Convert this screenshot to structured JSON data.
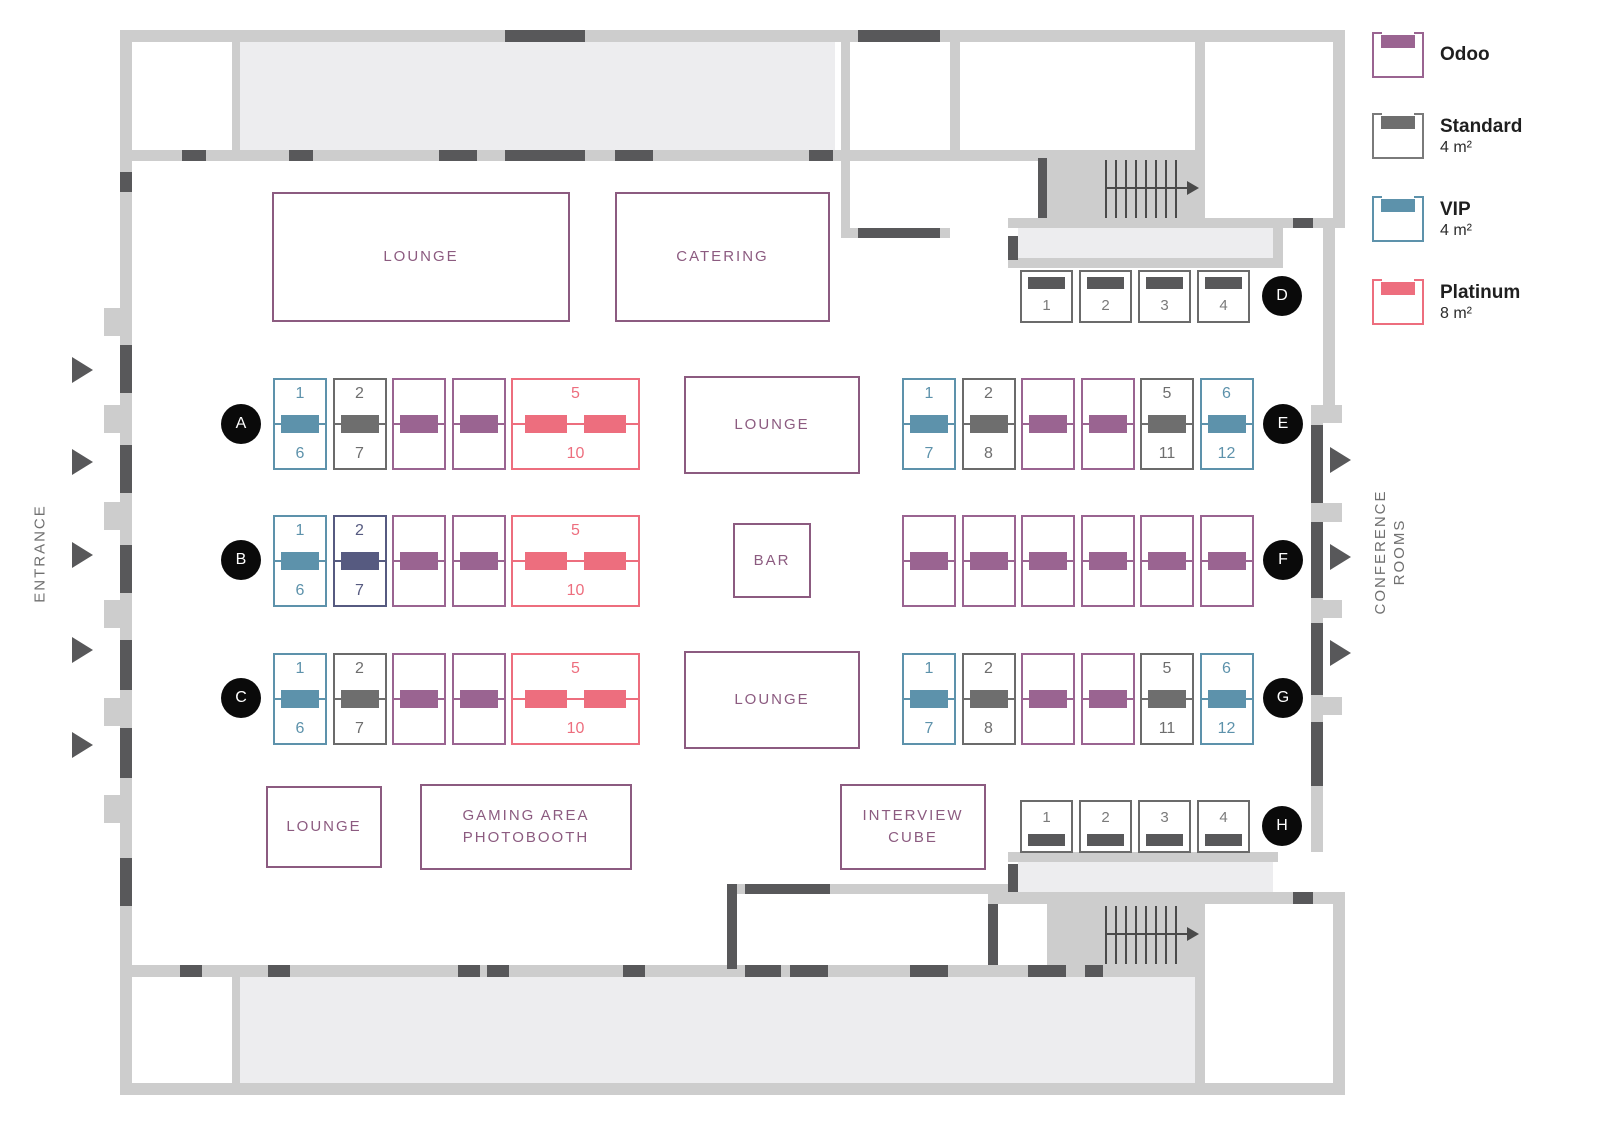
{
  "plan": {
    "entrance_label": "ENTRANCE",
    "conference_label_lines": [
      "CONFERENCE",
      "ROOMS"
    ]
  },
  "colors": {
    "odoo": "#9a6491",
    "standard": "#6e6e6e",
    "standard_border": "#6b6b6b",
    "vip": "#5d92ab",
    "platinum": "#ed6e7e",
    "indigo": "#565a80",
    "wall": "#cdcdcd",
    "room_fill": "#ededef",
    "door": "#58585a",
    "marker_bg": "#0a0a0a",
    "area_text": "#8c5b80",
    "side_label": "#707070"
  },
  "legend": {
    "items": [
      {
        "id": "odoo",
        "label": "Odoo",
        "size": ""
      },
      {
        "id": "standard",
        "label": "Standard",
        "size": "4 m²"
      },
      {
        "id": "vip",
        "label": "VIP",
        "size": "4 m²"
      },
      {
        "id": "platinum",
        "label": "Platinum",
        "size": "8 m²"
      }
    ]
  },
  "areas": [
    {
      "key": "lounge-top",
      "lines": [
        "LOUNGE"
      ]
    },
    {
      "key": "catering",
      "lines": [
        "CATERING"
      ]
    },
    {
      "key": "lounge-middle",
      "lines": [
        "LOUNGE"
      ]
    },
    {
      "key": "bar",
      "lines": [
        "BAR"
      ]
    },
    {
      "key": "lounge-lower",
      "lines": [
        "LOUNGE"
      ]
    },
    {
      "key": "lounge-small",
      "lines": [
        "LOUNGE"
      ]
    },
    {
      "key": "gaming",
      "lines": [
        "GAMING AREA",
        "PHOTOBOOTH"
      ]
    },
    {
      "key": "interview",
      "lines": [
        "INTERVIEW",
        "CUBE"
      ]
    }
  ],
  "rows": [
    {
      "id": "A",
      "booths": [
        {
          "type": "vip",
          "top": "1",
          "bottom": "6"
        },
        {
          "type": "standard",
          "top": "2",
          "bottom": "7"
        },
        {
          "type": "odoo"
        },
        {
          "type": "odoo"
        },
        {
          "type": "platinum",
          "top": "5",
          "bottom": "10"
        }
      ]
    },
    {
      "id": "B",
      "booths": [
        {
          "type": "vip",
          "top": "1",
          "bottom": "6"
        },
        {
          "type": "indigo",
          "top": "2",
          "bottom": "7"
        },
        {
          "type": "odoo"
        },
        {
          "type": "odoo"
        },
        {
          "type": "platinum",
          "top": "5",
          "bottom": "10"
        }
      ]
    },
    {
      "id": "C",
      "booths": [
        {
          "type": "vip",
          "top": "1",
          "bottom": "6"
        },
        {
          "type": "standard",
          "top": "2",
          "bottom": "7"
        },
        {
          "type": "odoo"
        },
        {
          "type": "odoo"
        },
        {
          "type": "platinum",
          "top": "5",
          "bottom": "10"
        }
      ]
    },
    {
      "id": "D",
      "booths": [
        {
          "type": "standard",
          "num": "1"
        },
        {
          "type": "standard",
          "num": "2"
        },
        {
          "type": "standard",
          "num": "3"
        },
        {
          "type": "standard",
          "num": "4"
        }
      ]
    },
    {
      "id": "E",
      "booths": [
        {
          "type": "vip",
          "top": "1",
          "bottom": "7"
        },
        {
          "type": "standard",
          "top": "2",
          "bottom": "8"
        },
        {
          "type": "odoo"
        },
        {
          "type": "odoo"
        },
        {
          "type": "standard",
          "top": "5",
          "bottom": "11"
        },
        {
          "type": "vip",
          "top": "6",
          "bottom": "12"
        }
      ]
    },
    {
      "id": "F",
      "booths": [
        {
          "type": "odoo"
        },
        {
          "type": "odoo"
        },
        {
          "type": "odoo"
        },
        {
          "type": "odoo"
        },
        {
          "type": "odoo"
        },
        {
          "type": "odoo"
        }
      ]
    },
    {
      "id": "G",
      "booths": [
        {
          "type": "vip",
          "top": "1",
          "bottom": "7"
        },
        {
          "type": "standard",
          "top": "2",
          "bottom": "8"
        },
        {
          "type": "odoo"
        },
        {
          "type": "odoo"
        },
        {
          "type": "standard",
          "top": "5",
          "bottom": "11"
        },
        {
          "type": "vip",
          "top": "6",
          "bottom": "12"
        }
      ]
    },
    {
      "id": "H",
      "booths": [
        {
          "type": "standard",
          "num": "1"
        },
        {
          "type": "standard",
          "num": "2"
        },
        {
          "type": "standard",
          "num": "3"
        },
        {
          "type": "standard",
          "num": "4"
        }
      ]
    }
  ]
}
